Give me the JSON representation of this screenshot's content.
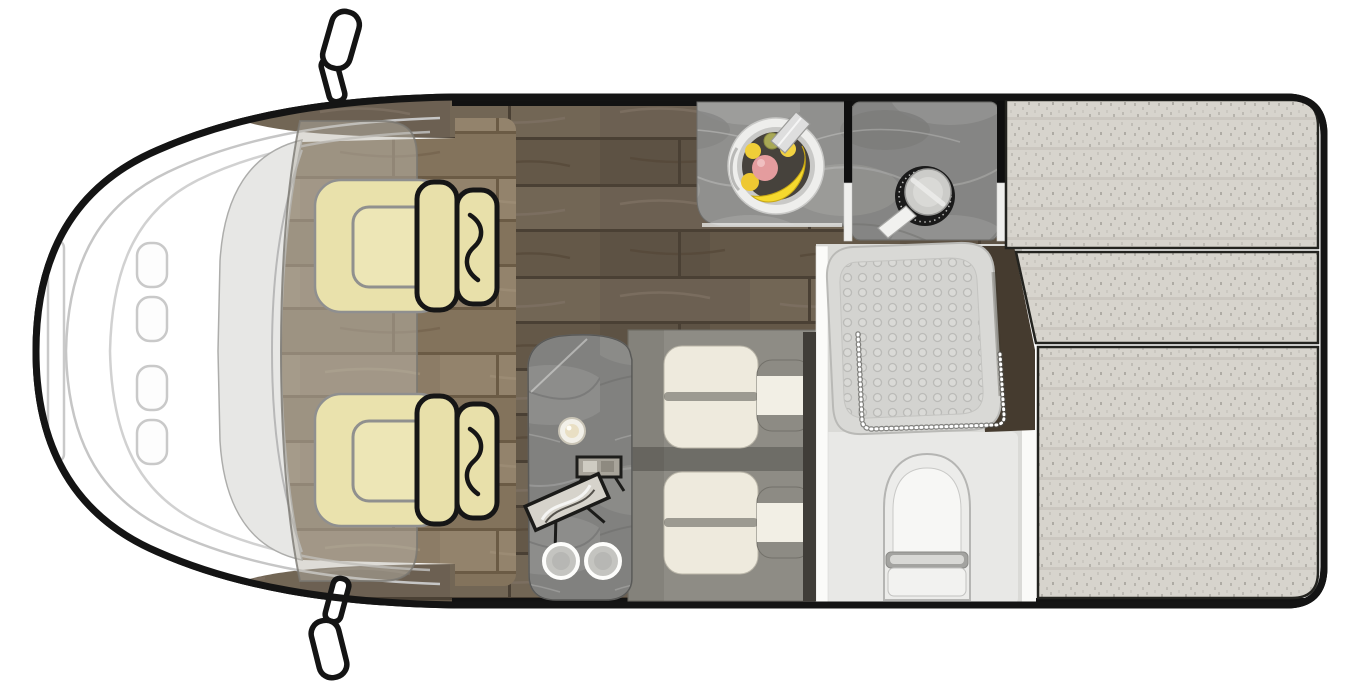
{
  "meta": {
    "title": "Motorhome floor plan — overhead view",
    "type": "floorplan",
    "orientation": "vehicle front at left, rear at right"
  },
  "colors": {
    "page_bg": "#ffffff",
    "body_outline": "#141414",
    "hood_white": "#ffffff",
    "hood_line_gray": "#c6c6c6",
    "windshield_gray": "#e7e7e5",
    "cab_overlay": "rgba(186,181,171,0.48)",
    "wood_dark_base": "#6c6052",
    "wood_tan_base": "#8c7c66",
    "seat_yellow": "#e9e1ab",
    "seat_inner_yellow": "#ede6b6",
    "seat_outline_black": "#161616",
    "marble_gray": "#90908e",
    "bench_gray": "#8e8c85",
    "cushion_cream": "#eeeadd",
    "bolster_gray": "#8d8b84",
    "bolster_white": "#f2efe5",
    "table_plate_gray": "#c4c4c0",
    "bed_fabric": "#d7d4cd",
    "bed_seam_black": "#23231f",
    "wedge_brown": "#453b2f",
    "bathroom_floor": "#dadad7",
    "toilet_zone": "#e8e8e6",
    "shower_tray": "#d9d9d6",
    "toilet_white": "#ececea",
    "toilet_bowl_white": "#f7f7f5",
    "hinge_gray": "#a3a3a0",
    "wall_black": "#0f0f0f",
    "wall_white": "#fbfbf9",
    "divider_dark": "#403d38",
    "sink_rim_white": "#eeeeec",
    "sink_bowl_dark": "#46423c",
    "banana_yellow": "#f5d92e",
    "apple_pink": "#e49c9e",
    "lemon_yellow": "#f0ce38",
    "green_fruit": "#a8a855",
    "faucet_chrome": "#dedede",
    "burner_black": "#1a1a1a",
    "pan_gray": "#ccccc9",
    "pan_handle_white": "#f1f1ef",
    "mirror_white": "#ffffff",
    "candle_cream": "#e9dfc4",
    "frame_black": "#1d1d1b"
  },
  "areas": {
    "cab": {
      "label": "driver cab",
      "seat_count": 2
    },
    "kitchen": {
      "label": "kitchen",
      "features": [
        "round sink with fruit bowl and faucet",
        "hob burner with frying pan"
      ]
    },
    "dinette": {
      "label": "dinette",
      "features": [
        "marble side table",
        "candle",
        "two display frames",
        "two plates",
        "two bench seats",
        "two bolster cushions"
      ]
    },
    "bathroom": {
      "label": "bathroom",
      "features": [
        "shower tray with curtain",
        "toilet"
      ]
    },
    "bed": {
      "label": "rear bed",
      "cushion_sections": 3
    },
    "exterior": {
      "label": "vehicle body",
      "mirror_count": 2
    }
  }
}
